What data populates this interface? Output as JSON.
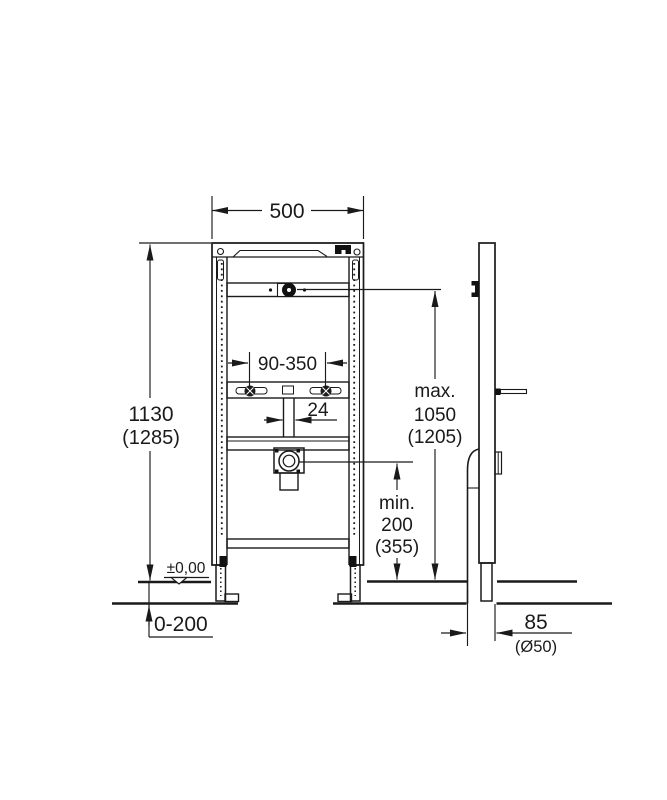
{
  "colors": {
    "ink": "#1a1a1a",
    "background": "#ffffff"
  },
  "dimensions": {
    "top_width": "500",
    "height_value": "1130",
    "height_alt": "(1285)",
    "bracket_range": "90-350",
    "pipe_width": "24",
    "max_prefix": "max.",
    "max_value": "1050",
    "max_alt": "(1205)",
    "min_prefix": "min.",
    "min_value": "200",
    "min_alt": "(355)",
    "datum_level": "±0,00",
    "floor_adjust_range": "0-200",
    "wall_distance": "85",
    "drain_diameter": "(Ø50)"
  }
}
